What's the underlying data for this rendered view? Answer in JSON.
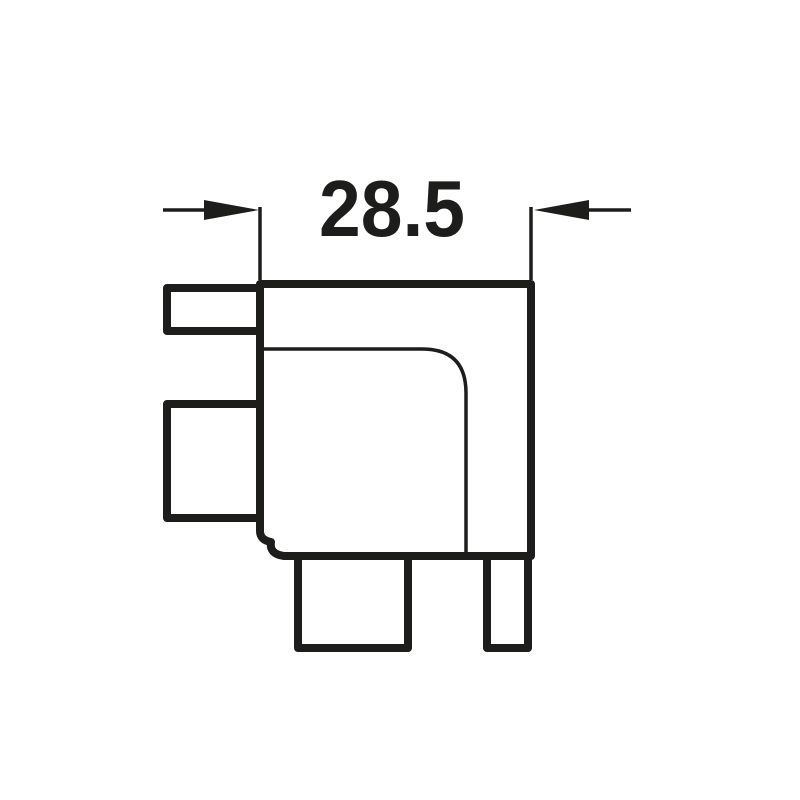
{
  "drawing": {
    "type": "technical-dimension-drawing",
    "part": "corner-fitting-profile",
    "dimension": {
      "label": "28.5"
    },
    "colors": {
      "line": "#1d1d1b",
      "background": "#ffffff"
    }
  }
}
